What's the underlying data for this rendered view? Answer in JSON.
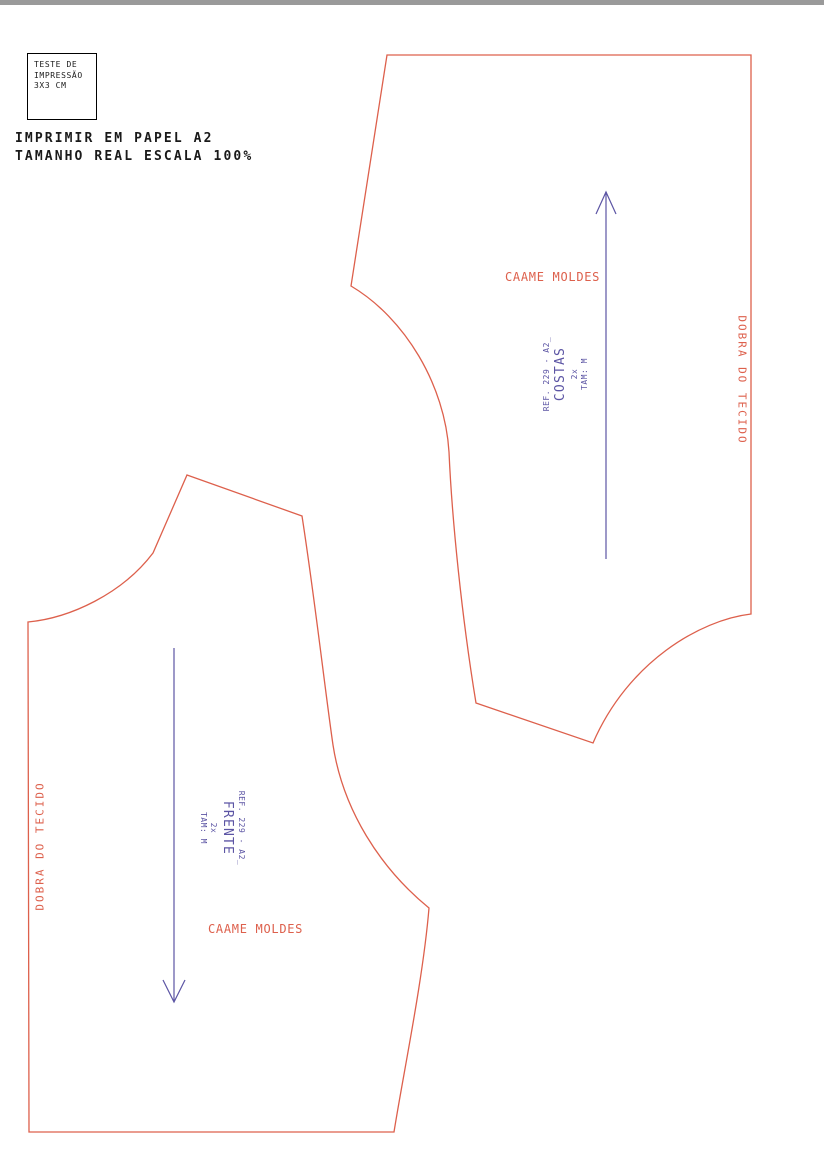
{
  "page": {
    "background": "#ffffff",
    "top_bar_color": "#9a9a9a"
  },
  "colors": {
    "outline_red": "#dd604c",
    "label_red": "#dd604c",
    "label_purple": "#5c55a4",
    "text_black": "#1a1a1a"
  },
  "print_test_box": {
    "lines": [
      "TESTE DE",
      "IMPRESSÃO",
      "3X3 CM"
    ]
  },
  "instructions": {
    "line1": "IMPRIMIR EM PAPEL A2",
    "line2": "TAMANHO REAL ESCALA 100%"
  },
  "pieces": {
    "back": {
      "brand": "CAAME MOLDES",
      "label": {
        "ref": "REF. 229 - A2_",
        "name": "COSTAS",
        "quantity": "2x",
        "size": "TAM: M"
      },
      "fold_label": "DOBRA DO TECIDO"
    },
    "front": {
      "brand": "CAAME MOLDES",
      "label": {
        "ref": "REF. 229 - A2_",
        "name": "FRENTE",
        "quantity": "2x",
        "size": "TAM: M"
      },
      "fold_label": "DOBRA DO TECIDO"
    }
  }
}
